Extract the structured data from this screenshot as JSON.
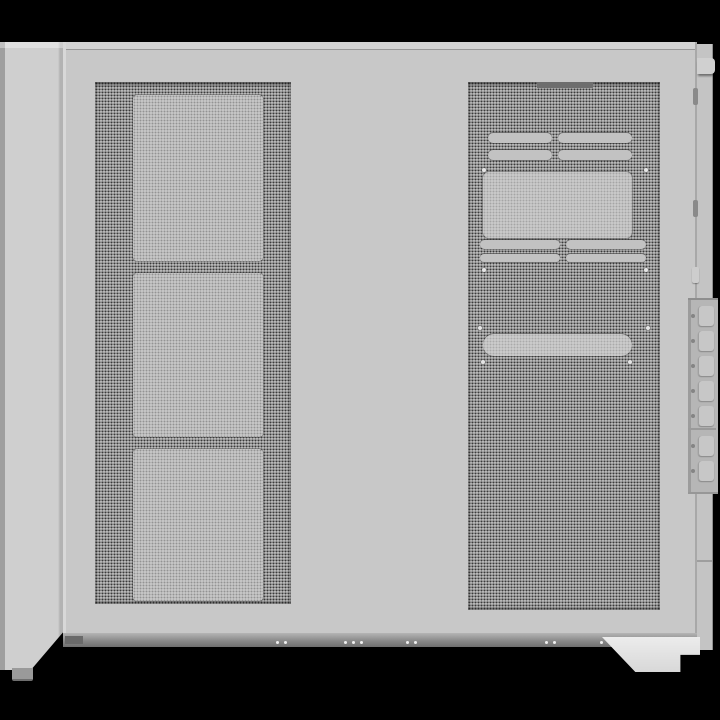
{
  "scene": {
    "type": "product-photo",
    "subject": "White mid-tower PC case, side view with perforated mesh panels",
    "background_color": "#000000"
  },
  "colors": {
    "bg": "#000000",
    "body": "#c8c8c8",
    "body_light": "#d3d3d3",
    "front_strip": "#cfcfcf",
    "seam": "#979797",
    "mesh_base": "#a8a8a8",
    "mesh_dot": "#3a3a3a",
    "filter": "#c6c6c6",
    "bracket": "#c2c2c2",
    "rear_strip": "#c4c4c4",
    "pci_strip": "#b6b6b6",
    "pci_cover": "#c7c7c7",
    "bottom_frame_dark": "#6a6a6a",
    "foot_left": "#9a9a9a",
    "foot_right": "#ececec"
  },
  "parts": {
    "left_mesh_panel": {
      "label": "side mesh panel",
      "fan_cutouts": 3
    },
    "right_mesh_panel": {
      "label": "rear chamber mesh panel",
      "vent_slot_rows": 4,
      "screw_dots": 8,
      "screw_dot_offsets": [
        [
          14,
          86
        ],
        [
          176,
          86
        ],
        [
          14,
          186
        ],
        [
          176,
          186
        ],
        [
          10,
          244
        ],
        [
          178,
          244
        ],
        [
          13,
          278
        ],
        [
          160,
          278
        ]
      ]
    },
    "rear_panel": {
      "label": "rear edge",
      "expansion_slots": 7,
      "edge_vents": 2,
      "edge_vent_offsets_y": [
        88,
        200
      ]
    },
    "bottom_frame": {
      "screw_dots": 10,
      "screw_dot_offsets_x": [
        213,
        221,
        281,
        289,
        297,
        343,
        351,
        482,
        490,
        537
      ]
    },
    "feet": {
      "front_left": "front-left foot",
      "rear_right": "rear-right foot"
    }
  }
}
